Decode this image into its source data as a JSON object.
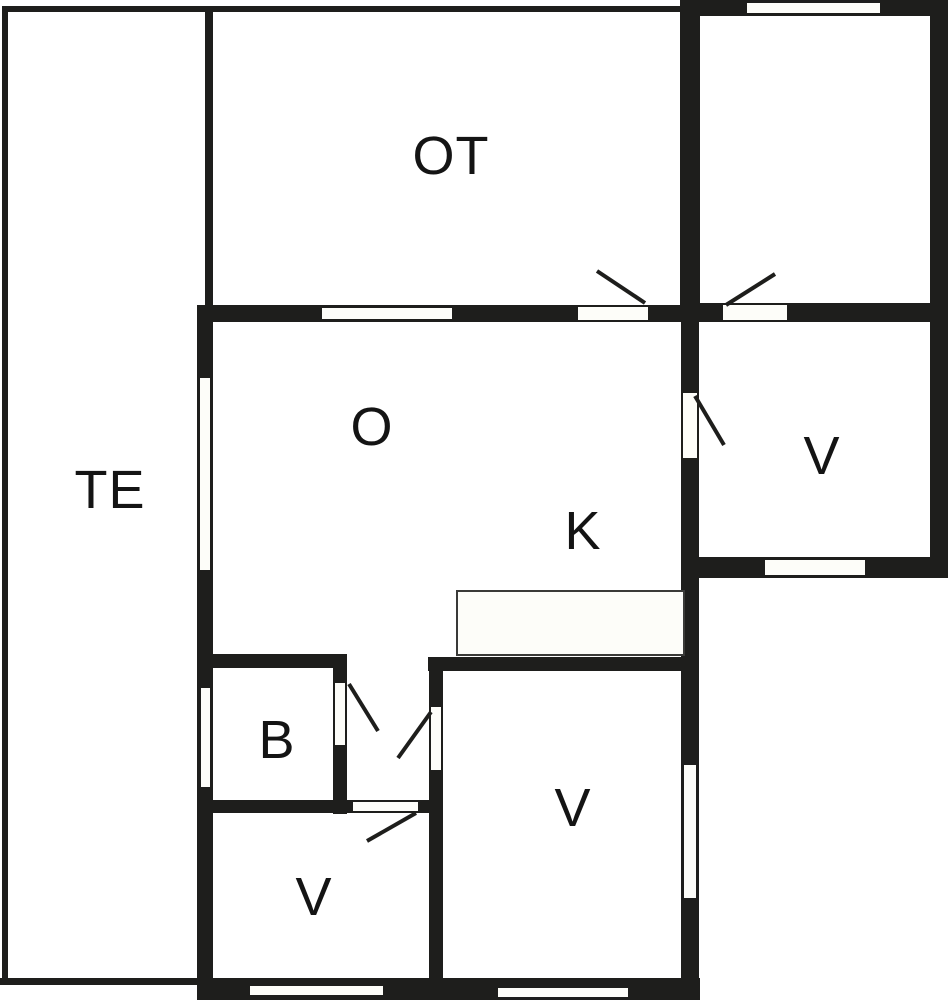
{
  "plan": {
    "type": "floor-plan",
    "rooms": {
      "te": {
        "label": "TE"
      },
      "ot": {
        "label": "OT"
      },
      "o": {
        "label": "O"
      },
      "k": {
        "label": "K"
      },
      "b": {
        "label": "B"
      },
      "v_right": {
        "label": "V"
      },
      "v_center": {
        "label": "V"
      },
      "v_left": {
        "label": "V"
      }
    },
    "colors": {
      "wall": "#1e1e1c",
      "background": "#ffffff",
      "floor": "#fdfdf9"
    }
  }
}
